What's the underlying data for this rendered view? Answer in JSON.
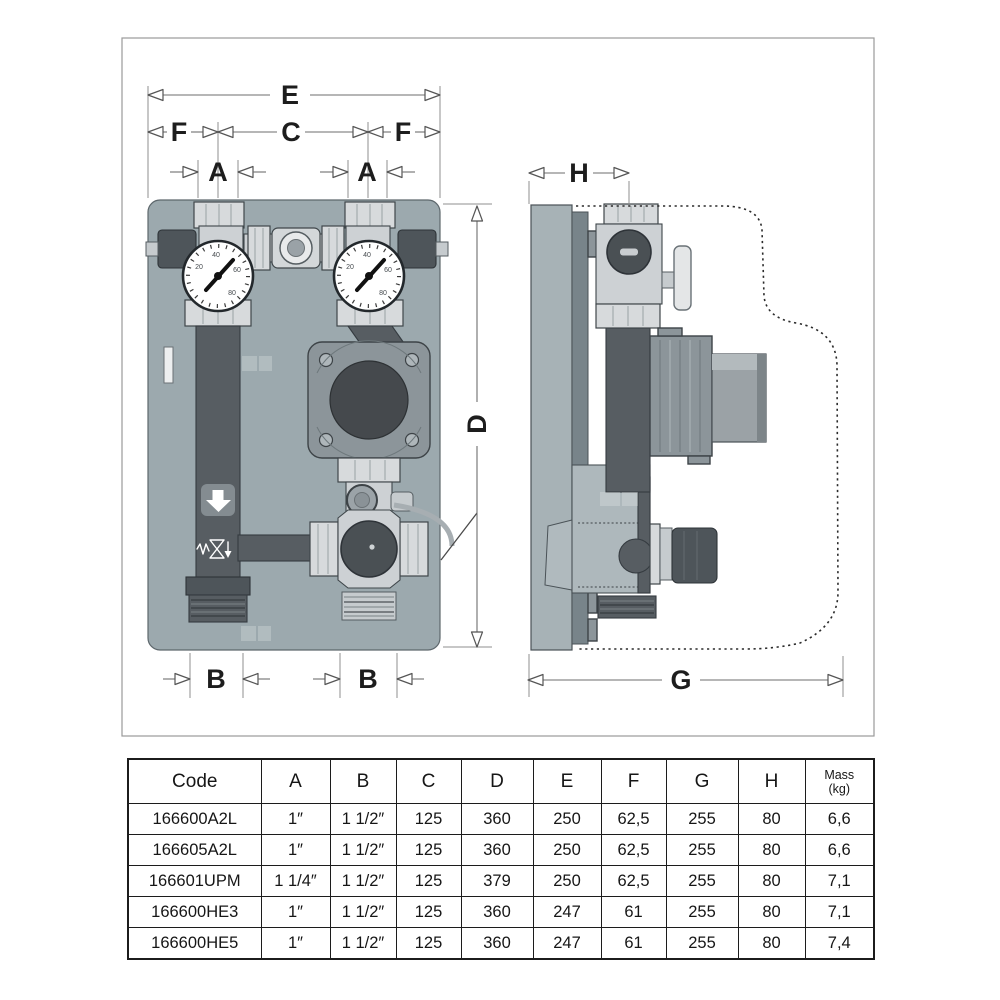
{
  "palette": {
    "panel": "#9CA9AE",
    "pipe_dark": "#575D62",
    "metal_light": "#D7DADC",
    "pump_flange": "#8C959A",
    "pump_dark": "#45494D",
    "side_slab": "#A7B2B6",
    "dimension_line": "#6E6E6E",
    "text": "#1D1D1D"
  },
  "diagram": {
    "labels": {
      "E": "E",
      "F_left": "F",
      "C": "C",
      "F_right": "F",
      "A_left": "A",
      "A_right": "A",
      "D": "D",
      "B_left": "B",
      "B_right": "B",
      "H": "H",
      "G": "G"
    },
    "gauge_ticks": [
      "20",
      "40",
      "60",
      "80"
    ]
  },
  "table": {
    "headers": [
      "Code",
      "A",
      "B",
      "C",
      "D",
      "E",
      "F",
      "G",
      "H"
    ],
    "mass": {
      "line1": "Mass",
      "line2": "(kg)"
    },
    "rows": [
      [
        "166600A2L",
        "1″",
        "1 1/2″",
        "125",
        "360",
        "250",
        "62,5",
        "255",
        "80",
        "6,6"
      ],
      [
        "166605A2L",
        "1″",
        "1 1/2″",
        "125",
        "360",
        "250",
        "62,5",
        "255",
        "80",
        "6,6"
      ],
      [
        "166601UPM",
        "1 1/4″",
        "1 1/2″",
        "125",
        "379",
        "250",
        "62,5",
        "255",
        "80",
        "7,1"
      ],
      [
        "166600HE3",
        "1″",
        "1 1/2″",
        "125",
        "360",
        "247",
        "61",
        "255",
        "80",
        "7,1"
      ],
      [
        "166600HE5",
        "1″",
        "1 1/2″",
        "125",
        "360",
        "247",
        "61",
        "255",
        "80",
        "7,4"
      ]
    ]
  }
}
